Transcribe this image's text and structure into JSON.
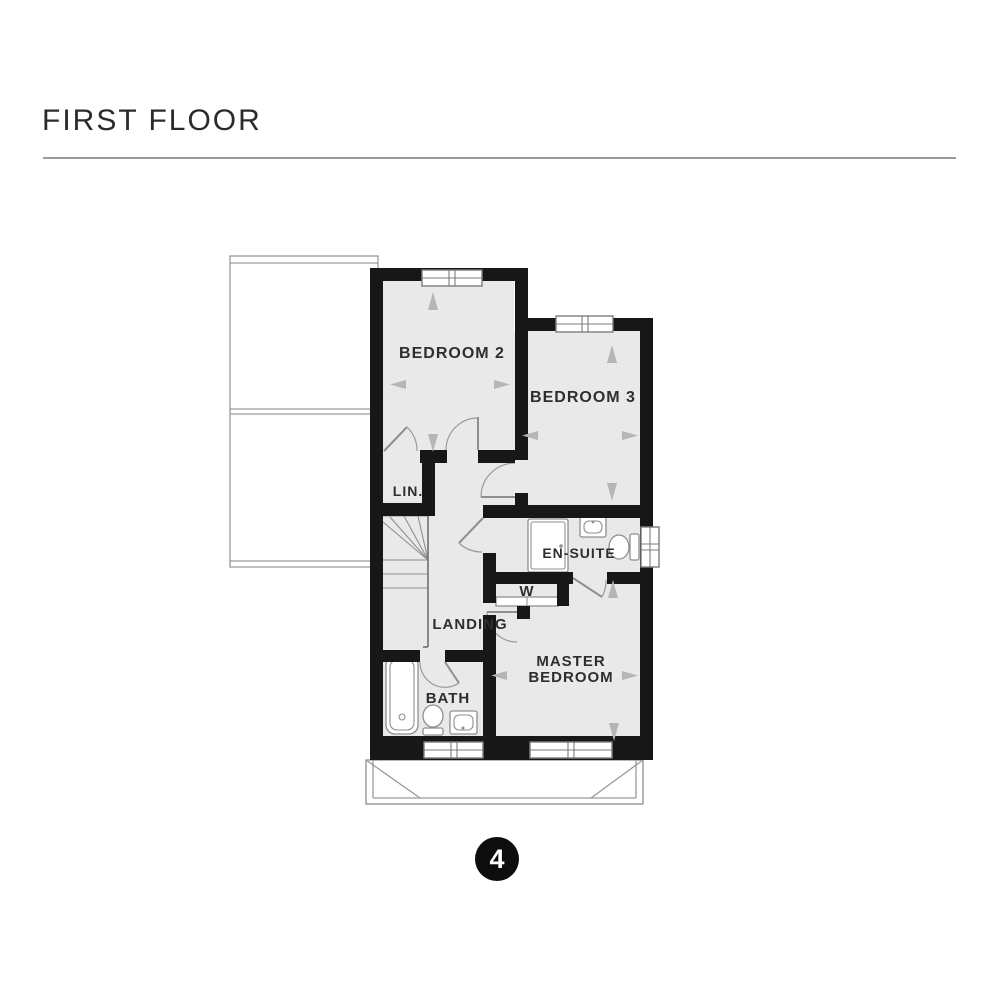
{
  "header": {
    "title": "FIRST FLOOR"
  },
  "floorplan": {
    "rooms": {
      "bedroom2": "BEDROOM 2",
      "bedroom3": "BEDROOM 3",
      "linen": "LIN.",
      "ensuite": "EN-SUITE",
      "wardrobe": "W",
      "landing": "LANDING",
      "master_line1": "MASTER",
      "master_line2": "BEDROOM",
      "bath": "BATH"
    },
    "plot_badge": "4",
    "fixture_icons": [
      "bathtub-icon",
      "toilet-icon",
      "sink-icon",
      "shower-icon",
      "stairs-icon",
      "window-icon",
      "door-swing-icon",
      "dimension-arrow-icon"
    ],
    "colors": {
      "wall": "#171717",
      "floor": "#e9e9e9",
      "fixture_line": "#8f8f8f",
      "arrow": "#b5b5b5",
      "rule": "#9b9b9b",
      "badge_bg": "#0d0d0d",
      "badge_text": "#ffffff"
    }
  }
}
